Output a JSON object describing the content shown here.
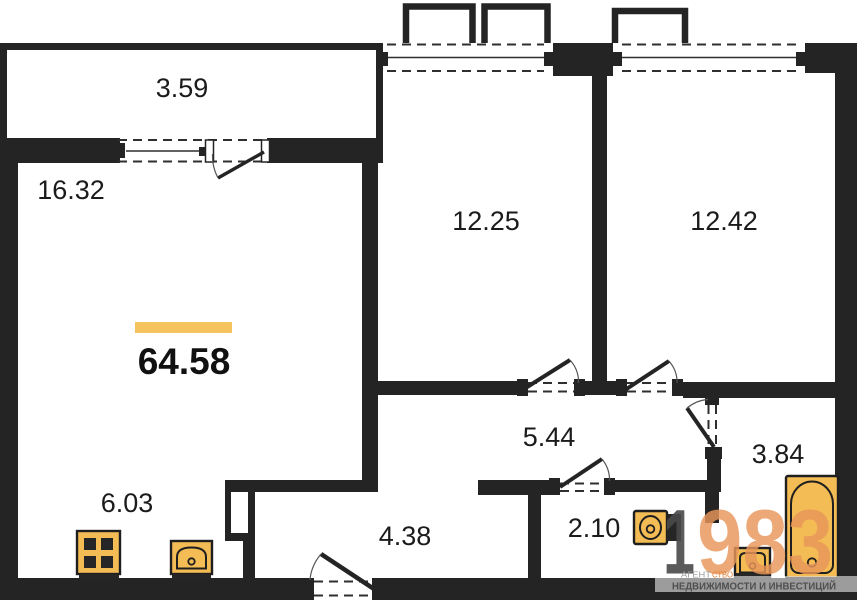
{
  "plan": {
    "total": {
      "area": "64.58"
    },
    "rooms": {
      "balcony": {
        "area": "3.59"
      },
      "living": {
        "area": "16.32"
      },
      "bedroom1": {
        "area": "12.25"
      },
      "bedroom2": {
        "area": "12.42"
      },
      "hallway": {
        "area": "5.44"
      },
      "bathroom": {
        "area": "3.84"
      },
      "wc": {
        "area": "2.10"
      },
      "corridor": {
        "area": "4.38"
      },
      "kitchen": {
        "area": "6.03"
      }
    },
    "colors": {
      "wall": "#242424",
      "fixture_fill": "#F3BC55",
      "accent_bar": "#F6C45E"
    }
  },
  "watermark": {
    "digit_gray": "1",
    "digits_orange": "983",
    "agency_prefix": "АГЕНТ",
    "agency_suffix": "СТВО",
    "tagline": "НЕДВИЖИМОСТИ И ИНВЕСТИЦИЙ",
    "colors": {
      "gray": "#4A4A4A",
      "orange": "#E9965A"
    }
  }
}
